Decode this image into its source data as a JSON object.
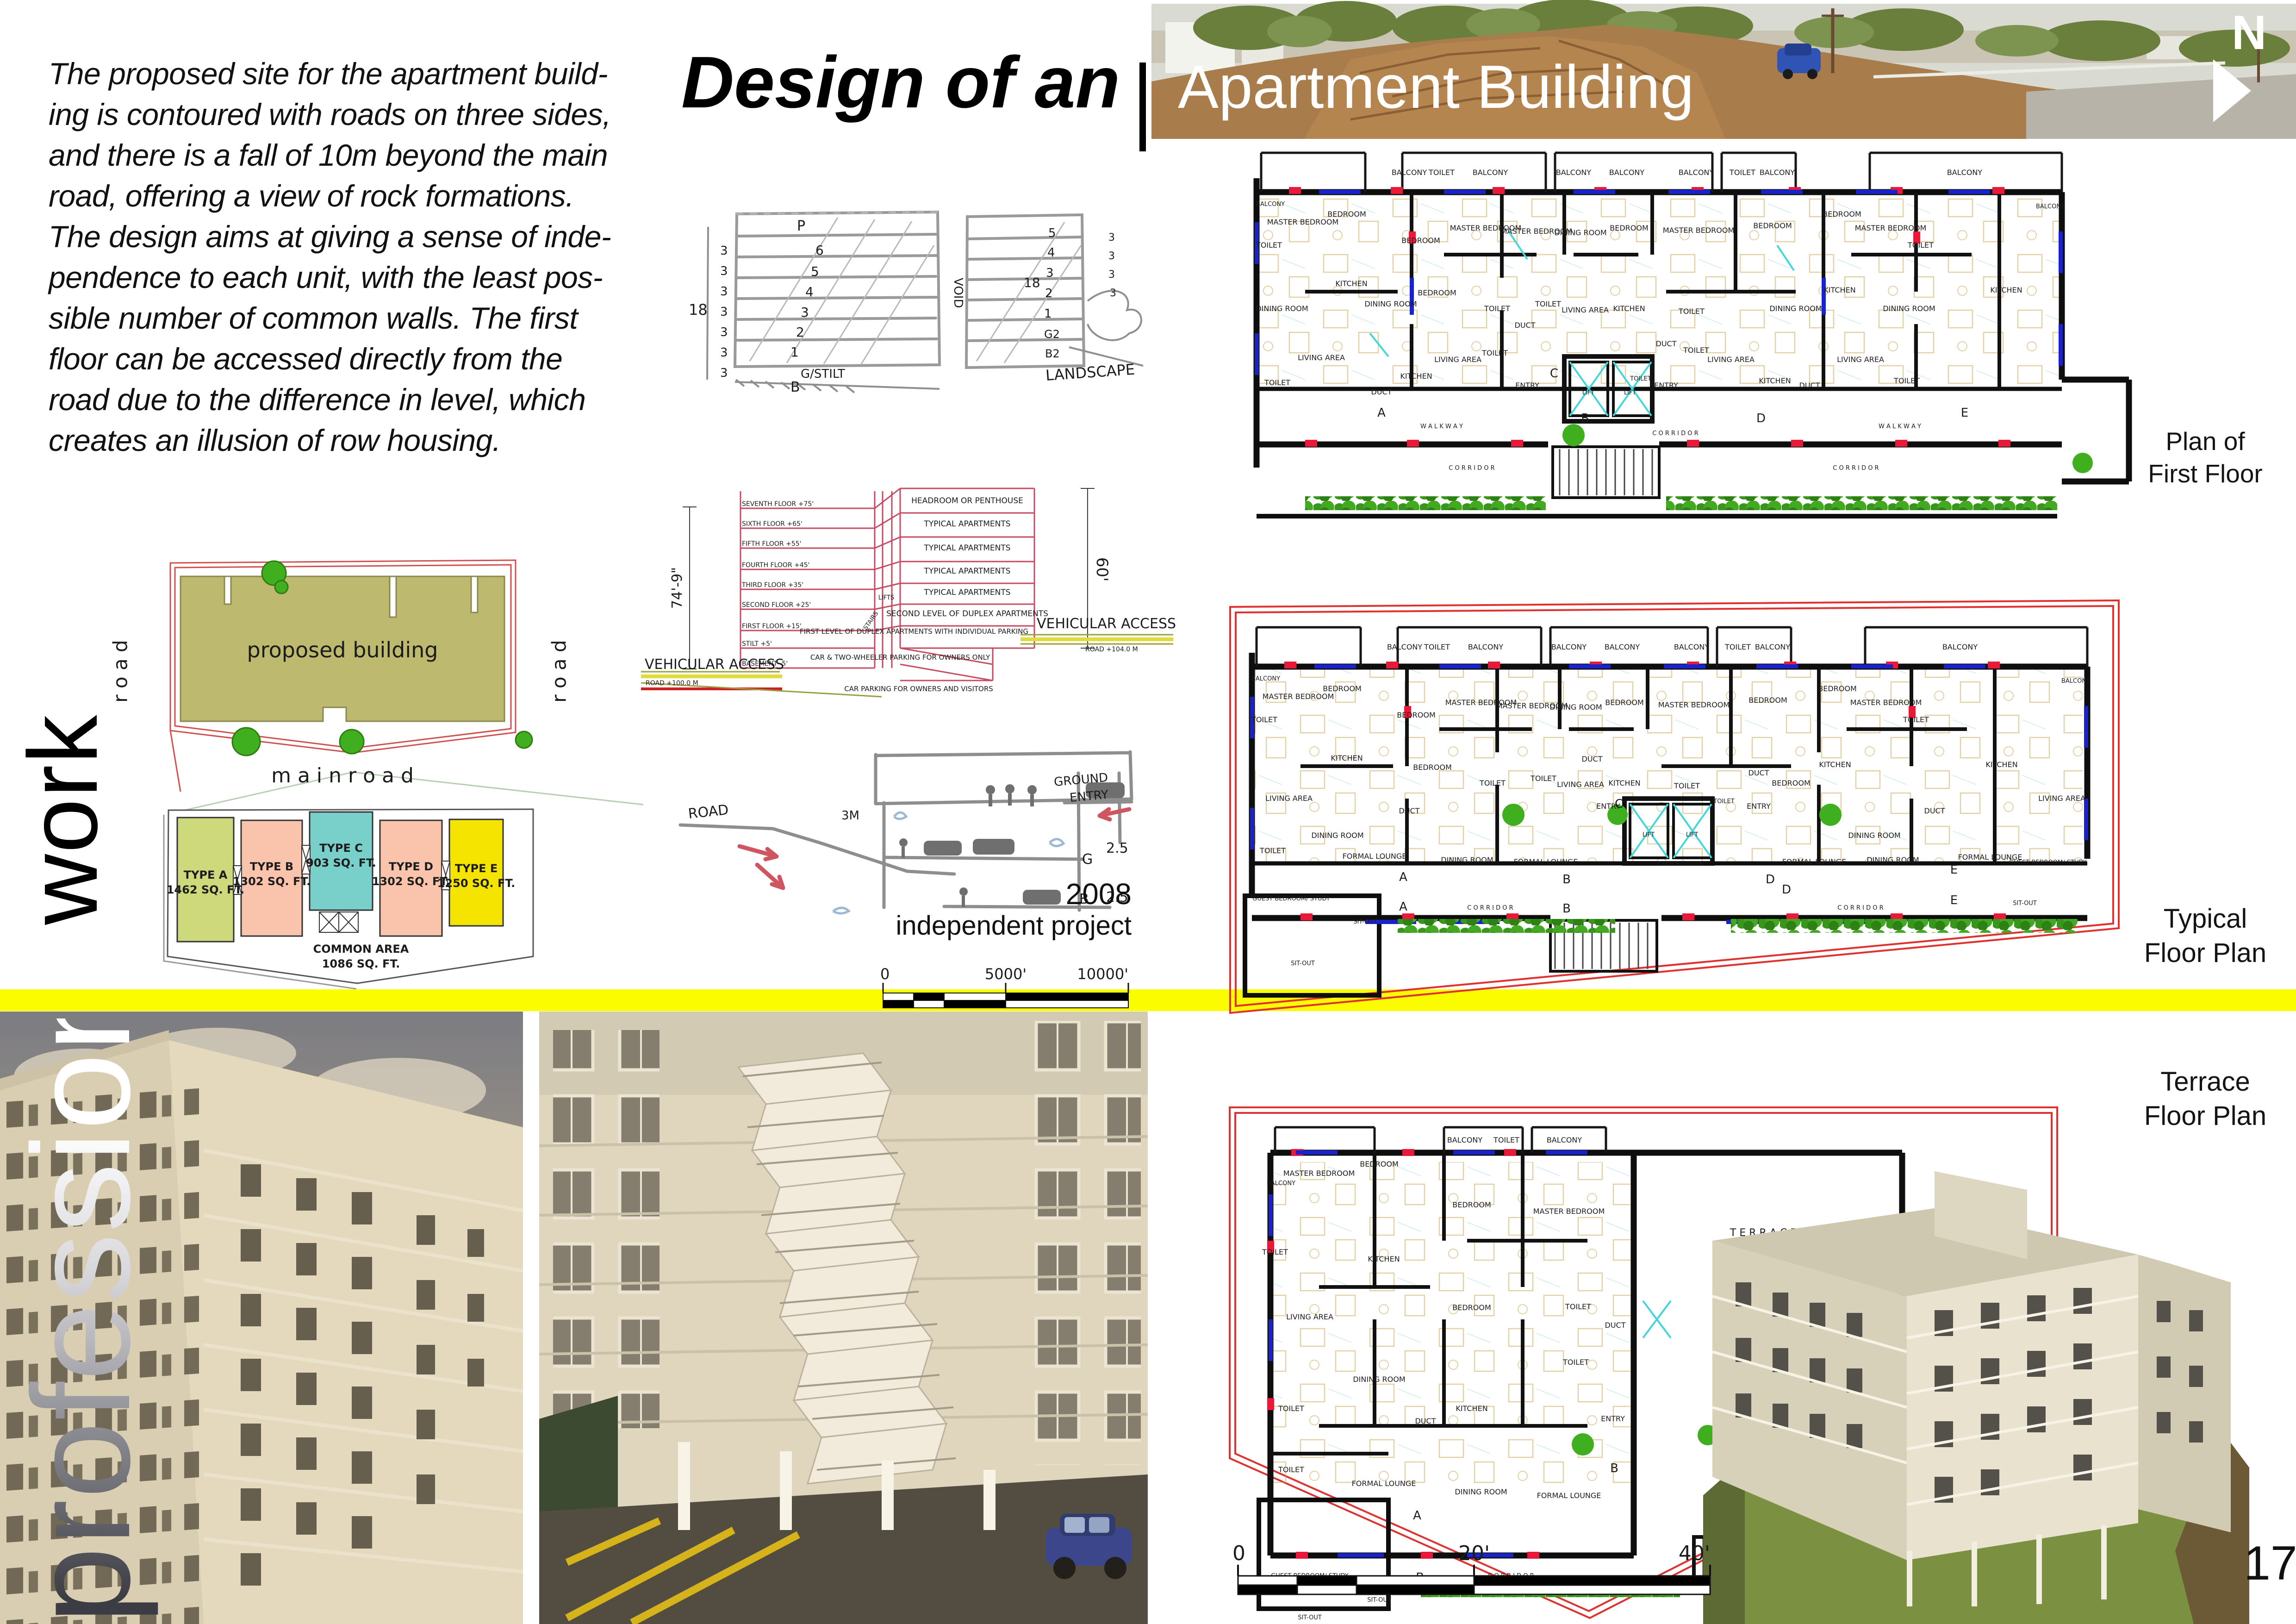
{
  "colors": {
    "accent_yellow": "#fcfc00",
    "cad_red": "#e81939",
    "cad_blue": "#1a22cc",
    "cad_cyan": "#45d6da",
    "plan_boundary_red": "#e03131",
    "section_line": "#c64a62",
    "hedge_green": "#3c9a1d",
    "site_olive": "#bdb96e",
    "type_a_lime": "#cdd97b",
    "type_bd_salmon": "#f9c3ac",
    "type_c_teal": "#79cfc9",
    "type_e_yellow": "#f5e400"
  },
  "intro_paragraph": "The proposed site for the apartment build-\ning is contoured with roads on three sides,\nand there is a fall of 10m beyond the main\nroad, offering a view of rock formations.\nThe design aims at giving a sense of inde-\npendence to each unit, with the least pos-\nsible number of common walls. The first\nfloor can be accessed directly from the\nroad due to the difference in level, which\ncreates an illusion of row housing.",
  "title": {
    "prefix": "Design of an",
    "main": "Apartment Building",
    "compass_n": "N"
  },
  "credit": {
    "year": "2008",
    "line": "independent project"
  },
  "page_number": "17",
  "side_labels": {
    "work": "work",
    "professional": "professional"
  },
  "site_plan": {
    "building": "proposed building",
    "road_left": "r o a d",
    "road_right": "r o a d",
    "main_road": "m a i n  r o a d"
  },
  "unit_legend": {
    "type_a": {
      "name": "TYPE A",
      "area": "1462 SQ. FT."
    },
    "type_b": {
      "name": "TYPE B",
      "area": "1302 SQ. FT."
    },
    "type_c": {
      "name": "TYPE C",
      "area": "903 SQ. FT."
    },
    "type_d": {
      "name": "TYPE D",
      "area": "1302 SQ. FT."
    },
    "type_e": {
      "name": "TYPE E",
      "area": "1250 SQ. FT."
    },
    "common": {
      "name": "COMMON AREA",
      "area": "1086 SQ. FT."
    }
  },
  "sketch_top": {
    "p": "P",
    "f6": "6",
    "f5": "5",
    "f4": "4",
    "f3": "3",
    "f2": "2",
    "f1": "1",
    "stilt": "G/STILT",
    "b": "B",
    "void": "VOID",
    "landscape": "LANDSCAPE",
    "d18": "18",
    "d3": "3",
    "r5": "5",
    "r4": "4",
    "r3": "3",
    "r2": "2",
    "r1": "1",
    "g2": "G2",
    "b2": "B2"
  },
  "sketch_mid": {
    "road": "ROAD",
    "m3": "3M",
    "ground": "GROUND",
    "entry": "ENTRY",
    "d25a": "2.5",
    "d25b": "2.5",
    "g": "G",
    "b": "B"
  },
  "section": {
    "floors": [
      "SEVENTH FLOOR +75'",
      "SIXTH FLOOR +65'",
      "FIFTH FLOOR +55'",
      "FOURTH FLOOR +45'",
      "THIRD FLOOR +35'",
      "SECOND FLOOR +25'",
      "FIRST FLOOR +15'",
      "STILT +5'",
      "BASEMENT -5'"
    ],
    "right": [
      "HEADROOM OR PENTHOUSE",
      "TYPICAL APARTMENTS",
      "TYPICAL APARTMENTS",
      "TYPICAL APARTMENTS",
      "TYPICAL APARTMENTS",
      "SECOND LEVEL OF DUPLEX APARTMENTS",
      "FIRST LEVEL OF DUPLEX APARTMENTS WITH INDIVIDUAL PARKING",
      "CAR & TWO-WHEELER PARKING FOR OWNERS ONLY",
      "CAR PARKING FOR OWNERS AND VISITORS"
    ],
    "stairs": "STAIRS",
    "lifts": "LIFTS",
    "dim_left": "74'-9\"",
    "dim_right": "60'",
    "veh_left_title": "VEHICULAR ACCESS",
    "veh_left_road": "ROAD +100.0 M",
    "veh_right_title": "VEHICULAR ACCESS",
    "veh_right_road": "ROAD +104.0 M"
  },
  "scalebar_site": {
    "t0": "0",
    "t1": "5000'",
    "t2": "10000'"
  },
  "scalebar_plan": {
    "t0": "0",
    "t1": "20'",
    "t2": "40'"
  },
  "captions": {
    "first": "Plan of\nFirst Floor",
    "typical": "Typical\nFloor Plan",
    "terrace": "Terrace\nFloor Plan"
  },
  "rooms": {
    "balcony": "BALCONY",
    "toilet": "TOILET",
    "master_bedroom": "MASTER BEDROOM",
    "bedroom": "BEDROOM",
    "kitchen": "KITCHEN",
    "dining_room": "DINING ROOM",
    "living_area": "LIVING AREA",
    "duct": "DUCT",
    "entry": "ENTRY",
    "lift": "LIFT",
    "lift_room": "LIFT ROOM",
    "corridor": "C O R R I D O R",
    "walkway": "W A L K W A Y",
    "terrace": "T E R R A C E",
    "formal_lounge": "FORMAL LOUNGE",
    "guest_bedroom": "GUEST BEDROOM/ STUDY",
    "sit_out": "SIT-OUT"
  },
  "markers": {
    "a": "A",
    "b": "B",
    "c": "C",
    "d": "D",
    "e": "E"
  }
}
